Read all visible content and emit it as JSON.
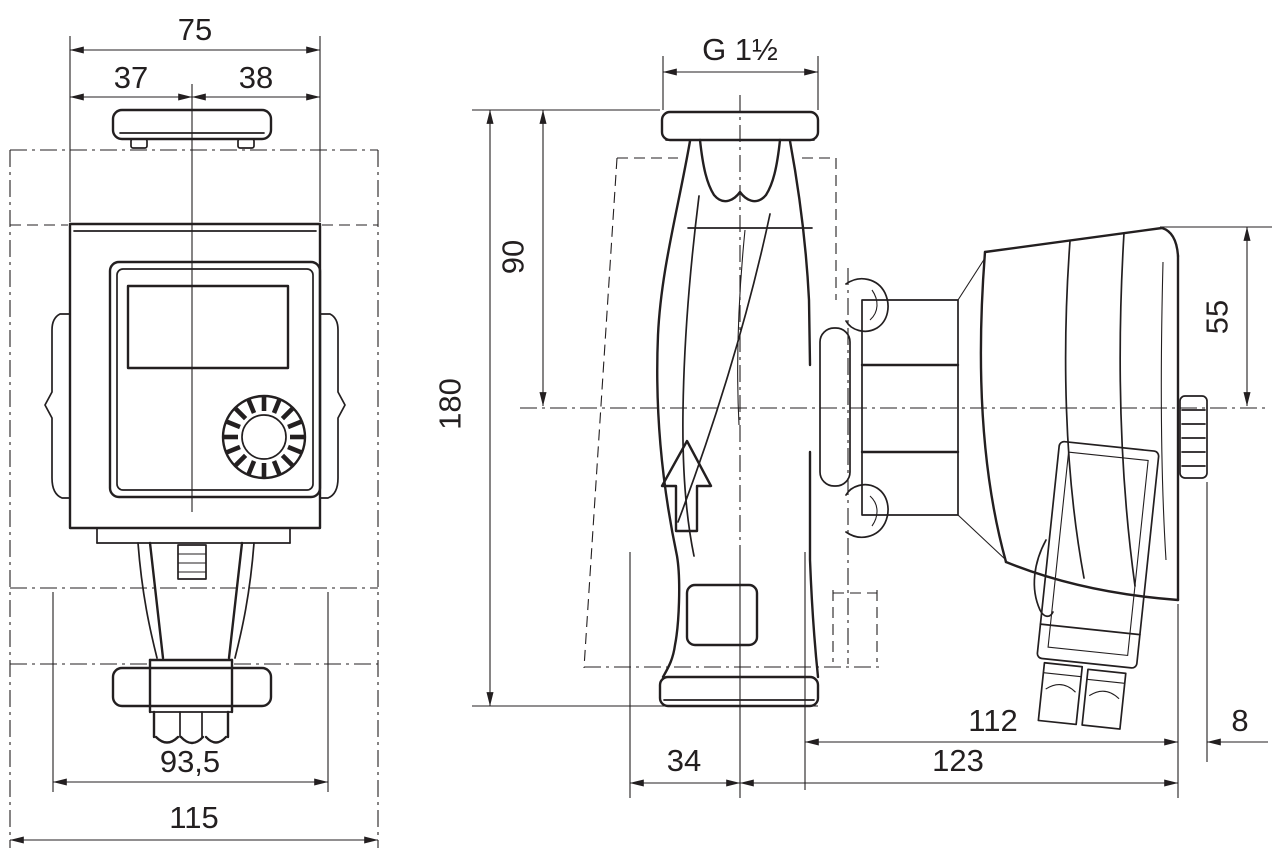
{
  "drawing": {
    "type": "technical-dimension-drawing",
    "subject": "circulation-pump-two-views",
    "style": {
      "line_color": "#231f20",
      "background": "#ffffff"
    },
    "labels": {
      "front_width_total": "75",
      "front_width_left": "37",
      "front_width_right": "38",
      "front_flange_width": "93,5",
      "front_base_width": "115",
      "side_thread": "G 1½",
      "side_port_to_center": "90",
      "side_total_height": "180",
      "side_center_to_motor_top": "55",
      "side_center_offset": "34",
      "side_motor_length": "112",
      "side_total_length": "123",
      "side_plug_clearance": "8"
    }
  }
}
